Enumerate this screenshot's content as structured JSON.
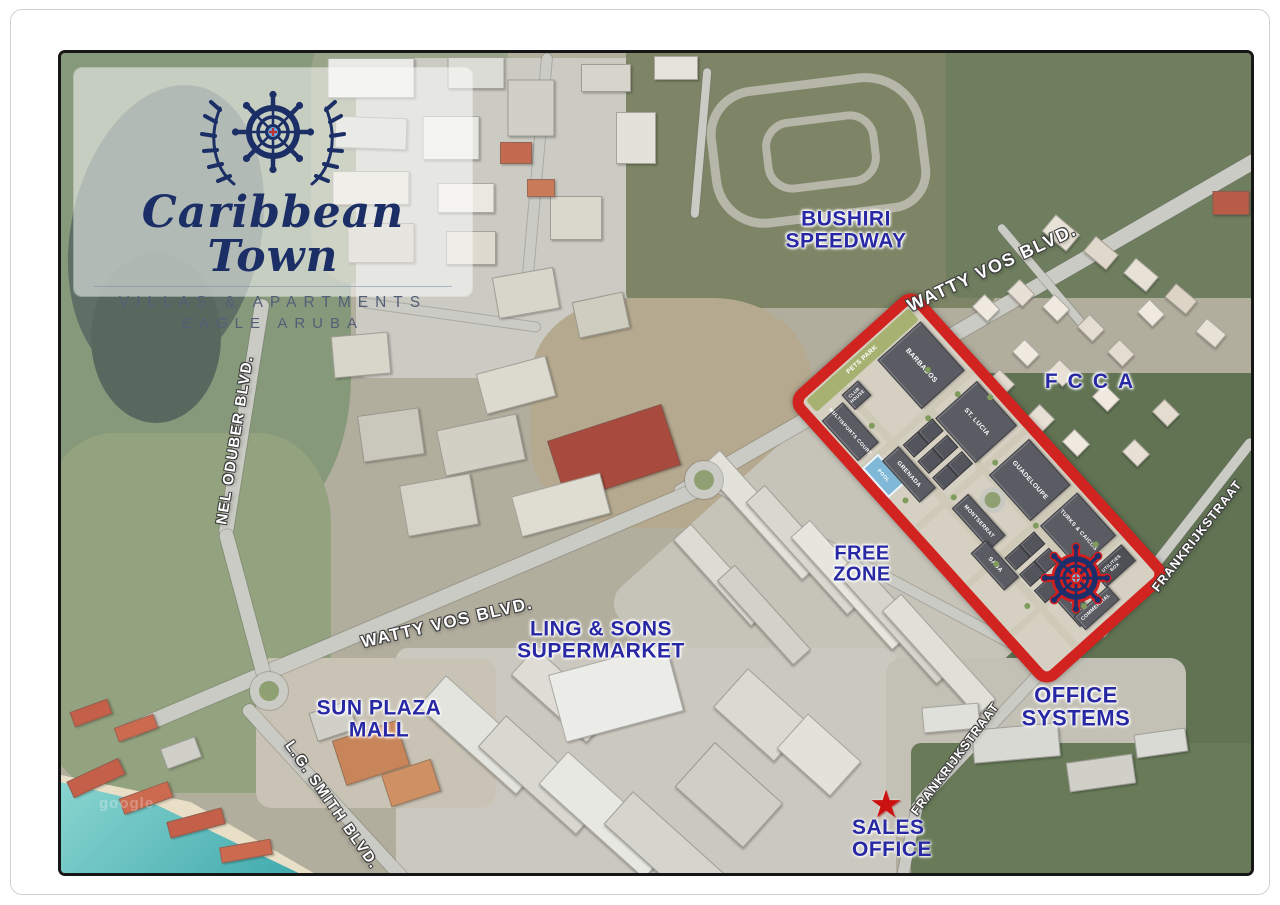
{
  "brand": {
    "name": "Caribbean Town",
    "tagline": "VILLAS & APARTMENTS",
    "location": "EAGLE ARUBA"
  },
  "pois": {
    "bushiri_speedway": "BUSHIRI\nSPEEDWAY",
    "fcca": "FCCA",
    "free_zone": "FREE\nZONE",
    "ling_and_sons": "LING & SONS\nSUPERMARKET",
    "sun_plaza_mall": "SUN PLAZA\nMALL",
    "office_systems": "OFFICE SYSTEMS",
    "sales_office": "SALES\nOFFICE"
  },
  "roads": {
    "watty_vos_blvd_ne": "WATTY VOS BLVD.",
    "watty_vos_blvd_sw": "WATTY VOS BLVD.",
    "nel_oduber_blvd": "NEL ODUBER BLVD.",
    "lg_smith_blvd": "L.G. SMITH BLVD.",
    "frankrijkstraat_e": "FRANKRIJKSTRAAT",
    "frankrijkstraat_s": "FRANKRIJKSTRAAT"
  },
  "site": {
    "amenities": {
      "pets_park": "PETS PARK",
      "club_house": "CLUB\nHOUSE",
      "multisports_court": "MULTISPORTS COURT",
      "pool": "POOL",
      "utilities_box": "UTILITIES\nBOX",
      "commercial": "COMMERCIAL"
    },
    "buildings": [
      "BARBADOS",
      "GRENADA",
      "ST. LUCIA",
      "MONTSERRAT",
      "GUADELOUPE",
      "SABA",
      "TURKS & CAICOS",
      "DOMINICA"
    ]
  },
  "watermark": "google",
  "colors": {
    "navy": "#2828a4",
    "site-outline": "#d12420",
    "logo-navy": "#1b2f66",
    "star": "#cc1111",
    "wheel-red": "#cf1f1f"
  }
}
